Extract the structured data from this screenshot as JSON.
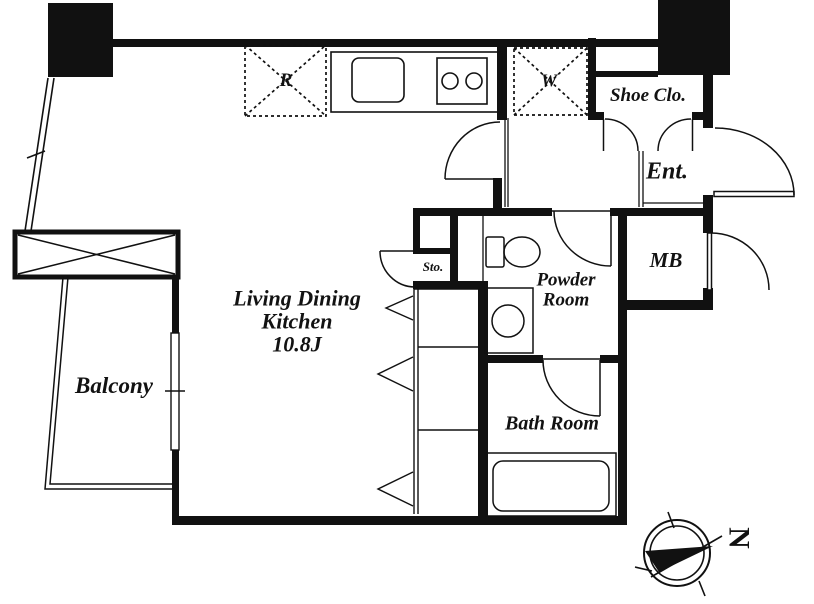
{
  "rooms": {
    "ldk": {
      "line1": "Living Dining",
      "line2": "Kitchen",
      "size": "10.8J"
    },
    "balcony": {
      "label": "Balcony"
    },
    "entrance": {
      "label": "Ent."
    },
    "shoe_closet": {
      "label": "Shoe Clo."
    },
    "meter_box": {
      "label": "MB"
    },
    "powder_room": {
      "line1": "Powder",
      "line2": "Room"
    },
    "bath_room": {
      "label": "Bath Room"
    },
    "storage": {
      "label": "Sto."
    }
  },
  "appliances": {
    "refrigerator_mark": "R",
    "washer_mark": "W"
  },
  "compass": {
    "north_label": "N"
  },
  "colors": {
    "line": "#111111",
    "background": "#ffffff"
  }
}
